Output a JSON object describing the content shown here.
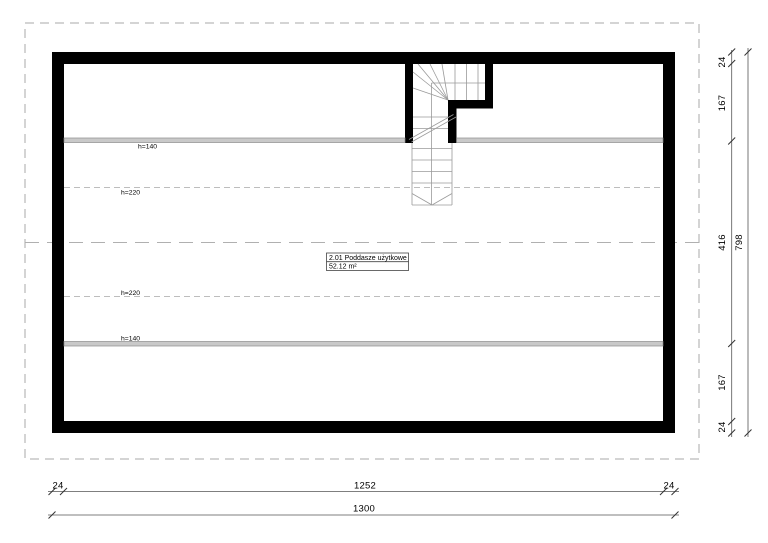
{
  "drawing": {
    "title_hint": "floor-plan",
    "room_label": {
      "name": "2.01 Poddasze użytkowe",
      "area": "52.12 m²"
    },
    "height_lines": {
      "h140": "h=140",
      "h220": "h=220"
    },
    "dim_right": {
      "segments": [
        "24",
        "167",
        "416",
        "167",
        "24"
      ],
      "total": "798"
    },
    "dim_bottom": {
      "segments": [
        "24",
        "1252",
        "24"
      ],
      "total": "1300"
    },
    "colors": {
      "wall": "#000000",
      "background": "#ffffff",
      "kneewall_bar": "#c9c9c9",
      "dashed_outline": "#a8a8a8",
      "stair_lines": "#9a9a9a",
      "dimension_lines": "#555555"
    }
  }
}
